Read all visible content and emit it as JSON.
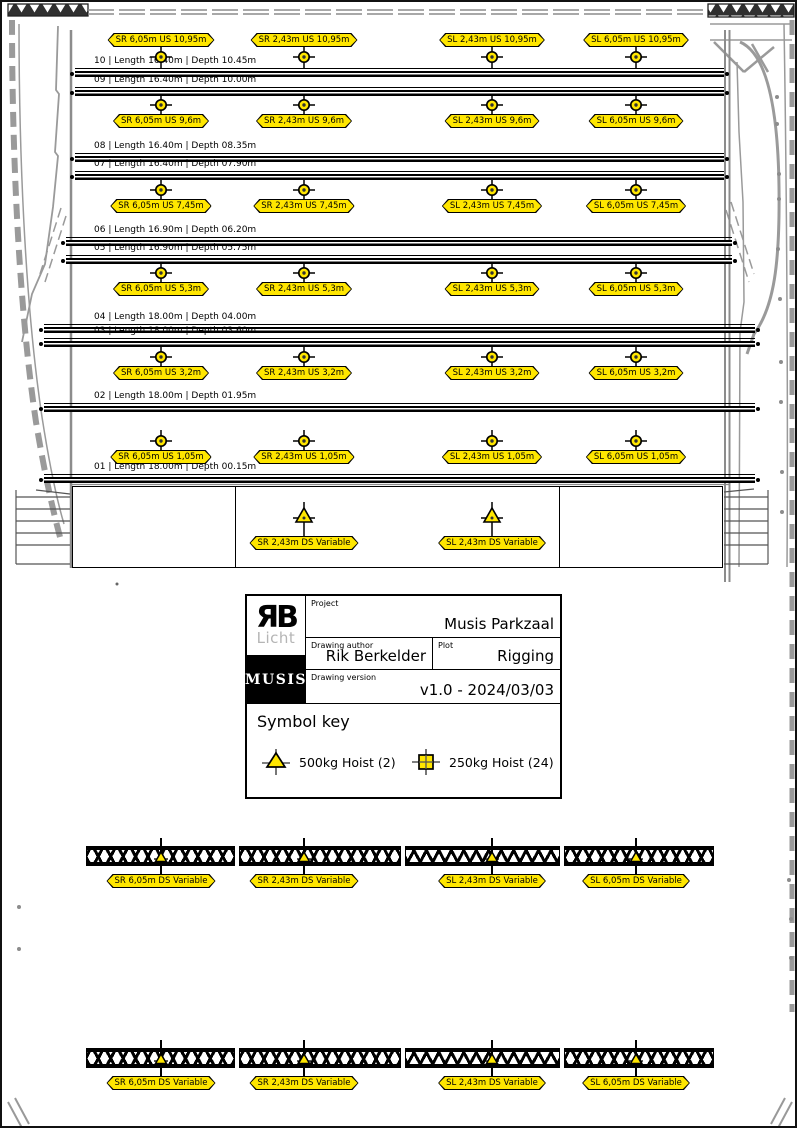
{
  "plan": {
    "flybar_lines": [
      "10 | Length 16.40m | Depth 10.45m",
      "09 | Length 16.40m | Depth 10.00m",
      "08 | Length 16.40m | Depth 08.35m",
      "07 | Length 16.40m | Depth 07.90m",
      "06 | Length 16.90m | Depth 06.20m",
      "05 | Length 16.90m | Depth 05.75m",
      "04 | Length 18.00m | Depth 04.00m",
      "03 | Length 18.00m | Depth 03.60m",
      "02 | Length 18.00m | Depth 01.95m",
      "01 | Length 18.00m | Depth 00.15m"
    ],
    "hoist_rows": [
      {
        "labels": [
          "SR 6,05m US 10,95m",
          "SR 2,43m US 10,95m",
          "SL 2,43m US 10,95m",
          "SL 6,05m US 10,95m"
        ]
      },
      {
        "labels": [
          "SR 6,05m US 9,6m",
          "SR 2,43m US 9,6m",
          "SL 2,43m US 9,6m",
          "SL 6,05m US 9,6m"
        ]
      },
      {
        "labels": [
          "SR 6,05m US 7,45m",
          "SR 2,43m US 7,45m",
          "SL 2,43m US 7,45m",
          "SL 6,05m US 7,45m"
        ]
      },
      {
        "labels": [
          "SR 6,05m US 5,3m",
          "SR 2,43m US 5,3m",
          "SL 2,43m US 5,3m",
          "SL 6,05m US 5,3m"
        ]
      },
      {
        "labels": [
          "SR 6,05m US 3,2m",
          "SR 2,43m US 3,2m",
          "SL 2,43m US 3,2m",
          "SL 6,05m US 3,2m"
        ]
      },
      {
        "labels": [
          "SR 6,05m US 1,05m",
          "SR 2,43m US 1,05m",
          "SL 2,43m US 1,05m",
          "SL 6,05m US 1,05m"
        ]
      }
    ],
    "ds_hoists": [
      "SR 2,43m DS Variable",
      "SL 2,43m DS Variable"
    ]
  },
  "trusses": [
    {
      "labels": [
        "SR 6,05m DS Variable",
        "SR 2,43m DS Variable",
        "SL 2,43m DS Variable",
        "SL 6,05m DS Variable"
      ]
    },
    {
      "labels": [
        "SR 6,05m DS Variable",
        "SR 2,43m DS Variable",
        "SL 2,43m DS Variable",
        "SL 6,05m DS Variable"
      ]
    }
  ],
  "title_block": {
    "logo_rb": "ЯB",
    "logo_licht": "Licht",
    "logo_musis": "MUSIS",
    "project_label": "Project",
    "project_value": "Musis Parkzaal",
    "author_label": "Drawing author",
    "author_value": "Rik Berkelder",
    "plot_label": "Plot",
    "plot_value": "Rigging",
    "version_label": "Drawing version",
    "version_value": "v1.0 - 2024/03/03"
  },
  "symbol_key": {
    "heading": "Symbol key",
    "items": [
      {
        "symbol": "hoist-500kg-triangle",
        "label": "500kg Hoist (2)"
      },
      {
        "symbol": "hoist-250kg-square",
        "label": "250kg Hoist (24)"
      }
    ]
  },
  "colors": {
    "hoist_yellow": "#FFE600",
    "line_black": "#000000",
    "architecture_gray": "#9a9a9a"
  }
}
